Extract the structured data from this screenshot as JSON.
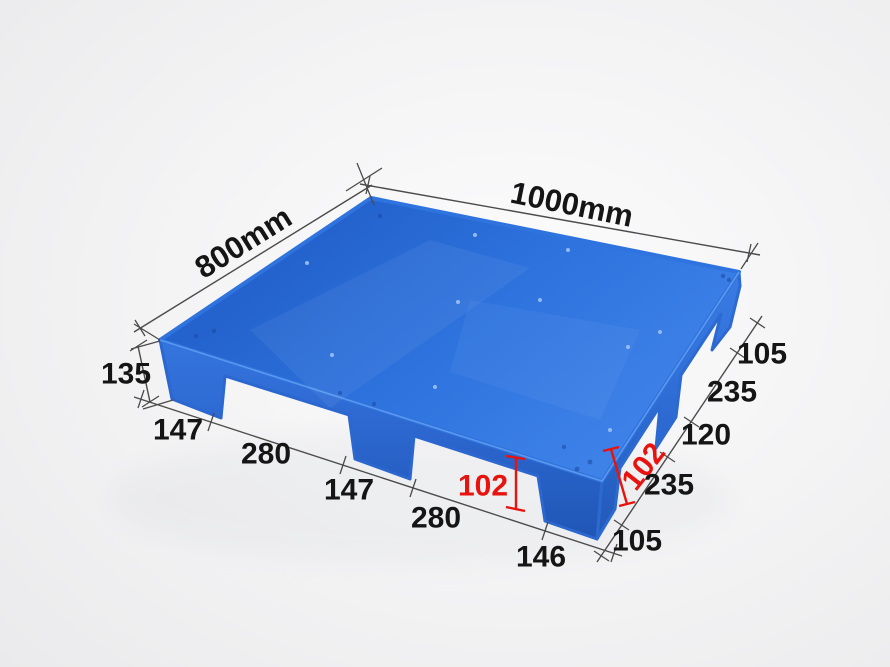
{
  "colors": {
    "background": "#ededee",
    "pallet_blue": "#2e73de",
    "pallet_blue_light": "#3f83e9",
    "pallet_blue_dark": "#2158b6",
    "dimension_line": "#4b4b4b",
    "label_black": "#151515",
    "label_red": "#e8130e"
  },
  "dimensions": {
    "length_label": "1000mm",
    "width_label": "800mm",
    "height_label": "135",
    "left_edge_segments": [
      "147",
      "280",
      "147",
      "280",
      "146"
    ],
    "right_edge_segments": [
      "105",
      "235",
      "120",
      "235",
      "105"
    ],
    "foot_opening_height_left": "102",
    "foot_opening_height_right": "102"
  }
}
